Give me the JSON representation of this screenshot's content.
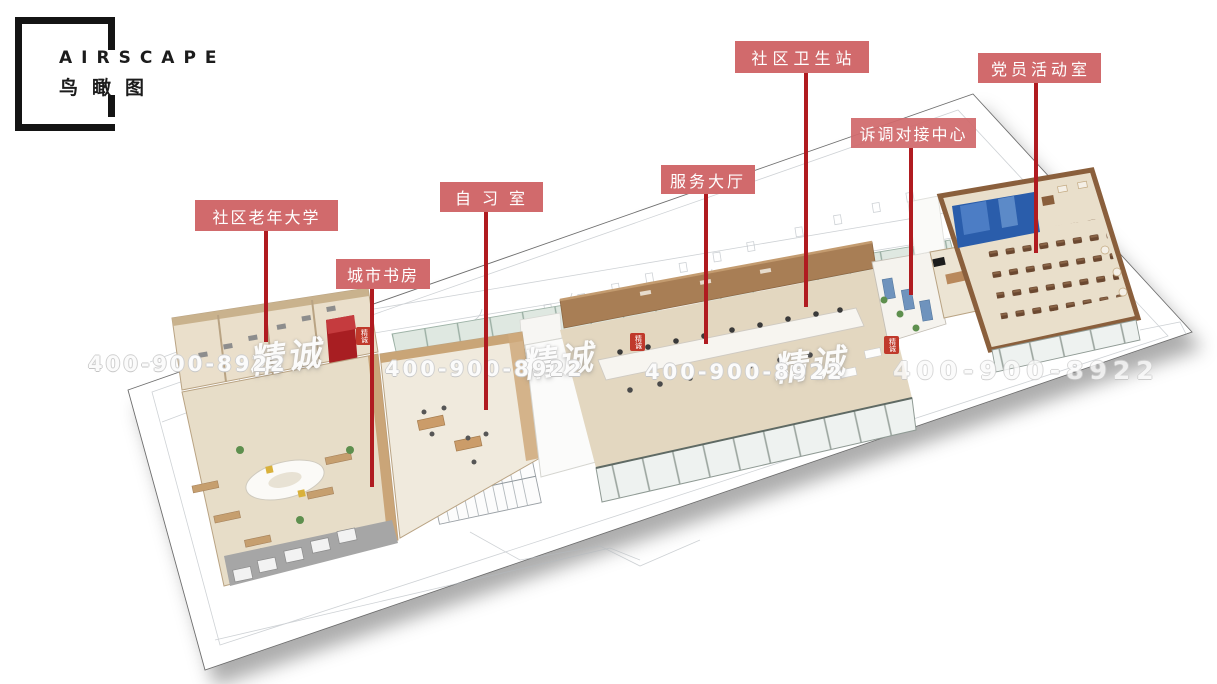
{
  "logo": {
    "brand": "AIRSCAPE",
    "subtitle": "鸟瞰图"
  },
  "labels": [
    {
      "id": "senior-university",
      "text": "社区老年大学"
    },
    {
      "id": "city-study",
      "text": "城市书房"
    },
    {
      "id": "study-room",
      "text": "自习室"
    },
    {
      "id": "service-hall",
      "text": "服务大厅"
    },
    {
      "id": "health-station",
      "text": "社区卫生站"
    },
    {
      "id": "mediation-center",
      "text": "诉调对接中心"
    },
    {
      "id": "party-room",
      "text": "党员活动室"
    }
  ],
  "watermark": {
    "script": "精诚",
    "phone": "400-900-8922",
    "seal": "精诚"
  },
  "colors": {
    "label_bg": "#d16a6c",
    "leader_line": "#b01b20",
    "booth_red": "#a81e22",
    "screen_blue": "#2a5dab",
    "wood_wall": "#a87e55"
  }
}
